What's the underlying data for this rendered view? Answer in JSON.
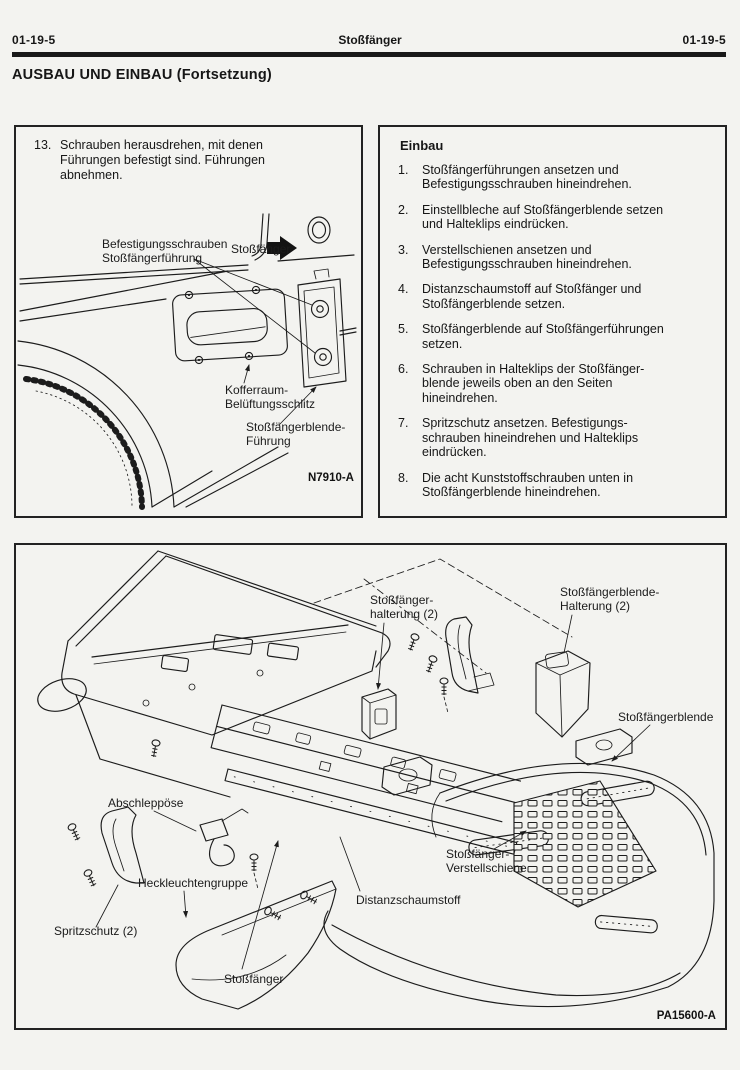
{
  "header": {
    "page_left": "01-19-5",
    "title": "Stoßfänger",
    "page_right": "01-19-5"
  },
  "section": {
    "title": "AUSBAU UND EINBAU (Fortsetzung)"
  },
  "panel_removal": {
    "step": {
      "num": "13.",
      "text": "Schrauben herausdrehen, mit denen\nFührungen befestigt sind. Führungen\nabnehmen."
    },
    "labels": {
      "fastening_screws_l1": "Befestigungsschrauben",
      "fastening_screws_l2": "Stoßfängerführung",
      "bumper": "Stoßfänger",
      "trunk_vent_l1": "Kofferraum-",
      "trunk_vent_l2": "Belüftungsschlitz",
      "cover_guide_l1": "Stoßfängerblende-",
      "cover_guide_l2": "Führung"
    },
    "figure_code": "N7910-A"
  },
  "panel_install": {
    "title": "Einbau",
    "steps": [
      {
        "num": "1.",
        "text": "Stoßfängerführungen ansetzen und\nBefestigungsschrauben hineindrehen."
      },
      {
        "num": "2.",
        "text": "Einstellbleche auf Stoßfängerblende setzen\nund Halteklips eindrücken."
      },
      {
        "num": "3.",
        "text": "Verstellschienen ansetzen und\nBefestigungsschrauben hineindrehen."
      },
      {
        "num": "4.",
        "text": "Distanzschaumstoff auf Stoßfänger und\nStoßfängerblende setzen."
      },
      {
        "num": "5.",
        "text": "Stoßfängerblende auf Stoßfängerführungen\nsetzen."
      },
      {
        "num": "6.",
        "text": "Schrauben in Halteklips der Stoßfänger-\nblende jeweils oben an den Seiten\nhineindrehen."
      },
      {
        "num": "7.",
        "text": "Spritzschutz ansetzen. Befestigungs-\nschrauben hineindrehen und Halteklips\neindrücken."
      },
      {
        "num": "8.",
        "text": "Die acht Kunststoffschrauben unten in\nStoßfängerblende hineindrehen."
      }
    ]
  },
  "panel_exploded": {
    "labels": {
      "bumper_bracket_l1": "Stoßfänger-",
      "bumper_bracket_l2": "halterung (2)",
      "cover_bracket_l1": "Stoßfängerblende-",
      "cover_bracket_l2": "Halterung (2)",
      "cover": "Stoßfängerblende",
      "tow_hook": "Abschleppöse",
      "tail_lamp": "Heckleuchtengruppe",
      "splash_shield": "Spritzschutz (2)",
      "bumper": "Stoßfänger",
      "foam": "Distanzschaumstoff",
      "adjust_rail_l1": "Stoßfänger-",
      "adjust_rail_l2": "Verstellschiene"
    },
    "figure_code": "PA15600-A"
  }
}
